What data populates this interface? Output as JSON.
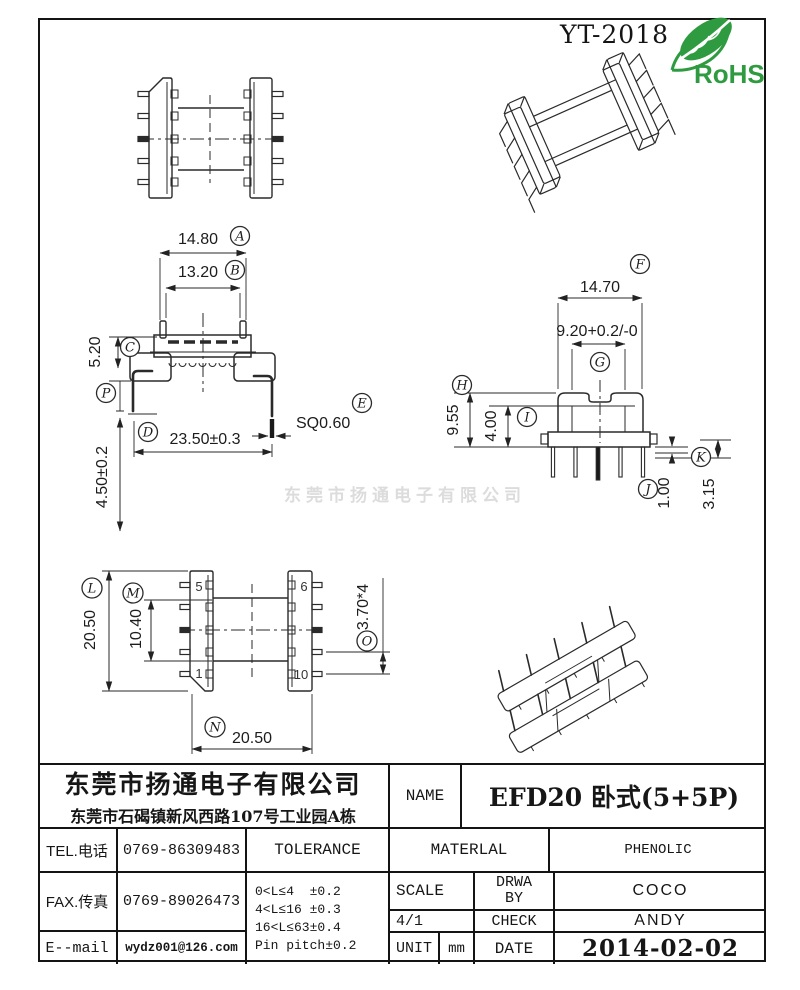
{
  "header": {
    "doc_code": "YT-2018",
    "rohs_label": "RoHS"
  },
  "watermark": "东莞市扬通电子有限公司",
  "colors": {
    "line": "#2a2a2a",
    "rohs_green": "#2f9b40",
    "watermark": "#dcdcdc"
  },
  "dims": {
    "A": {
      "letter": "A",
      "value": "14.80"
    },
    "B": {
      "letter": "B",
      "value": "13.20"
    },
    "C": {
      "letter": "C",
      "value": "5.20"
    },
    "D": {
      "letter": "D",
      "value": "23.50±0.3"
    },
    "E": {
      "letter": "E",
      "value": "SQ0.60"
    },
    "F": {
      "letter": "F",
      "value": "14.70"
    },
    "G": {
      "letter": "G",
      "value": "9.20+0.2/-0"
    },
    "H": {
      "letter": "H",
      "value": "9.55"
    },
    "I": {
      "letter": "I",
      "value": "4.00"
    },
    "J": {
      "letter": "J",
      "value": "1.00"
    },
    "K": {
      "letter": "K",
      "value": "3.15"
    },
    "L": {
      "letter": "L",
      "value": "20.50"
    },
    "M": {
      "letter": "M",
      "value": "10.40"
    },
    "N": {
      "letter": "N",
      "value": "20.50"
    },
    "O": {
      "letter": "O",
      "value": "3.70*4"
    },
    "P": {
      "letter": "P",
      "value": "4.50±0.2"
    }
  },
  "pin_labels": {
    "top_left": "5",
    "top_right": "6",
    "bottom_left": "1",
    "bottom_right": "10"
  },
  "title_block": {
    "company": "东莞市扬通电子有限公司",
    "address": "东莞市石碣镇新风西路107号工业园A栋",
    "tel_label": "TEL.电话",
    "tel_value": "0769-86309483",
    "fax_label": "FAX.传真",
    "fax_value": "0769-89026473",
    "email_label": "E--mail",
    "email_value": "wydz001@126.com",
    "tolerance_label": "TOLERANCE",
    "tolerance_rows": [
      "0<L≤4  ±0.2",
      "4<L≤16 ±0.3",
      "16<L≤63±0.4",
      "Pin pitch±0.2"
    ],
    "name_label": "NAME",
    "name_value": "EFD20 卧式(5+5P)",
    "material_label": "MATERLAL",
    "material_value": "PHENOLIC",
    "scale_label": "SCALE",
    "scale_value": "4/1",
    "drawn_label": "DRWA BY",
    "drawn_value": "COCO",
    "check_label": "CHECK",
    "check_value": "ANDY",
    "unit_label": "UNIT",
    "unit_value": "mm",
    "date_label": "DATE",
    "date_value": "2014-02-02"
  }
}
